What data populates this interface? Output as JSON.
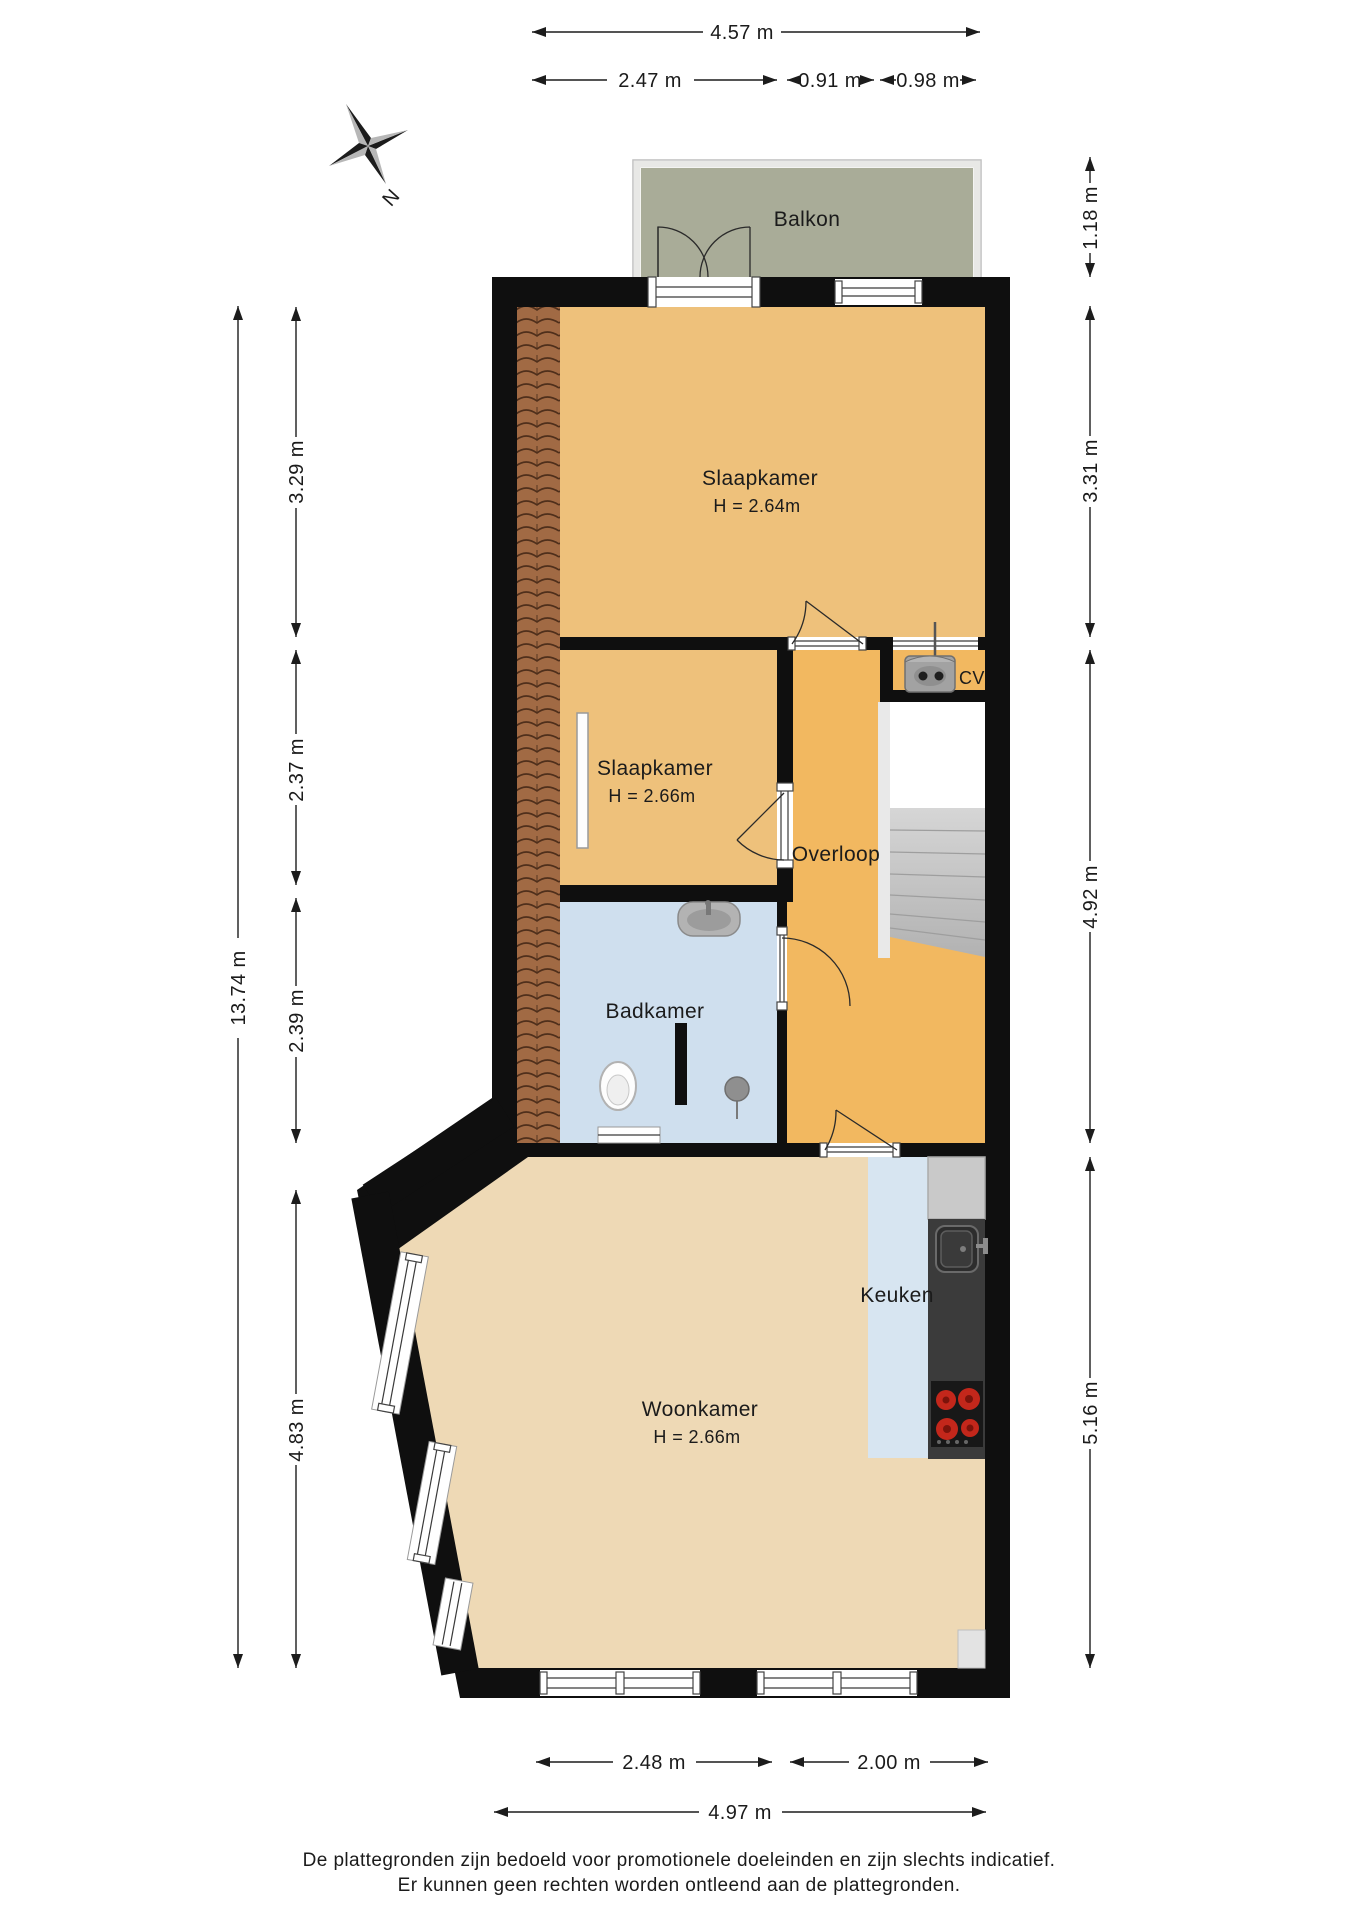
{
  "compass": {
    "label": "N"
  },
  "rooms": {
    "balkon": {
      "name": "Balkon"
    },
    "slaapkamer_boven": {
      "name": "Slaapkamer",
      "ceiling": "H = 2.64m"
    },
    "slaapkamer_klein": {
      "name": "Slaapkamer",
      "ceiling": "H = 2.66m"
    },
    "overloop": {
      "name": "Overloop"
    },
    "cv": {
      "name": "CV"
    },
    "badkamer": {
      "name": "Badkamer"
    },
    "keuken": {
      "name": "Keuken"
    },
    "woonkamer": {
      "name": "Woonkamer",
      "ceiling": "H = 2.66m"
    }
  },
  "dimensions": {
    "top": [
      {
        "label": "4.57 m"
      },
      {
        "label": "2.47 m"
      },
      {
        "label": "0.91 m"
      },
      {
        "label": "0.98 m"
      }
    ],
    "bottom": [
      {
        "label": "2.48 m"
      },
      {
        "label": "2.00 m"
      },
      {
        "label": "4.97 m"
      }
    ],
    "left": [
      {
        "label": "13.74 m"
      },
      {
        "label": "3.29 m"
      },
      {
        "label": "2.37 m"
      },
      {
        "label": "2.39 m"
      },
      {
        "label": "4.83 m"
      }
    ],
    "right": [
      {
        "label": "1.18 m"
      },
      {
        "label": "3.31 m"
      },
      {
        "label": "4.92 m"
      },
      {
        "label": "5.16 m"
      }
    ]
  },
  "footer": {
    "line1": "De plattegronden zijn bedoeld voor promotionele doeleinden en zijn slechts indicatief.",
    "line2": "Er kunnen geen rechten worden ontleend aan de plattegronden."
  },
  "colors": {
    "wall": "#0f0f0f",
    "bedroom_floor": "#eec17b",
    "hallway_floor": "#f2b860",
    "living_floor": "#eed9b5",
    "bathroom_floor": "#cfdfee",
    "kitchen_floor": "#d7e5f1",
    "balcony_floor": "#a9ac98",
    "roof_tiles": "#a16a44",
    "counter_dark": "#3b3b3b",
    "counter_light": "#c9c9c9",
    "stove_burner": "#c3271b",
    "stairs": "#c9c9c9"
  }
}
